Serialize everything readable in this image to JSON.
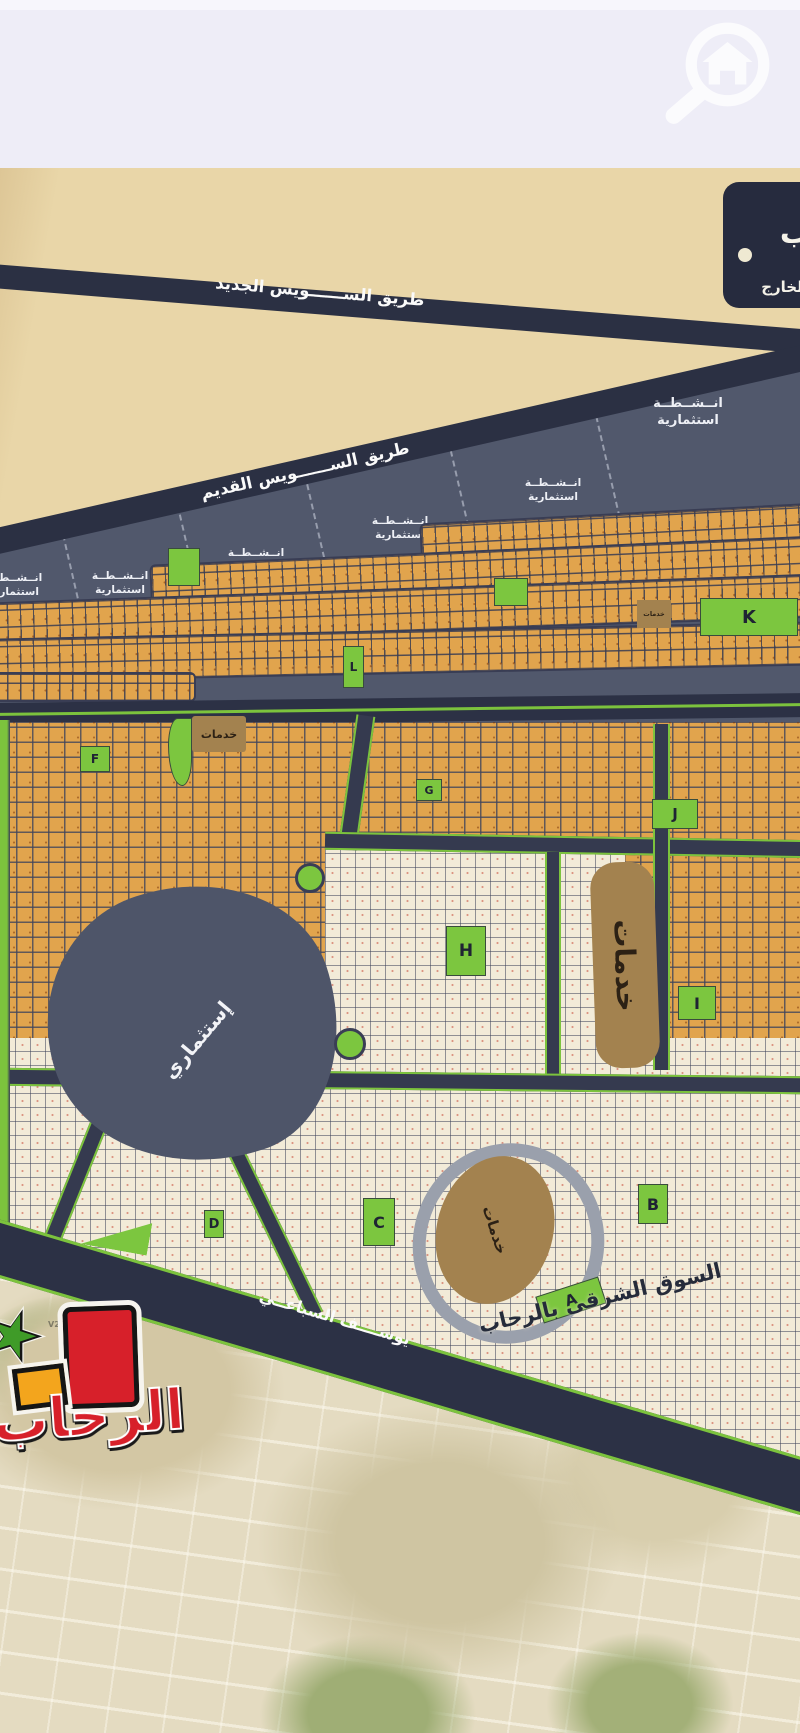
{
  "header": {
    "search_icon": "magnifier-with-house"
  },
  "legend": {
    "partial_letter": "ب",
    "subtitle": "بالخارج"
  },
  "roads": {
    "new_suez": "طريق الســــــويس الجديد",
    "old_suez": "طريق الســــــويس القديم",
    "youssef_elsebai": "يوســــف السباعــي",
    "east_market": "السوق الشرقى بالرحاب"
  },
  "zones": {
    "investment_line1": "انــشــطــة",
    "investment_line2": "استثمارية",
    "investment_blob": "إستثماري",
    "services": "خدمات"
  },
  "districts": {
    "a": "A",
    "b": "B",
    "c": "C",
    "d": "D",
    "f": "F",
    "g": "G",
    "h": "H",
    "i": "I",
    "j": "J",
    "k": "K",
    "l": "L"
  },
  "satellite_labels": {
    "v20": "V20",
    "v23": "V23",
    "v24": "V24"
  },
  "logo": {
    "text": "الرحاب"
  },
  "colors": {
    "road_navy": "#2b3043",
    "zone_navy": "#51586c",
    "plot_orange": "#e1a44d",
    "plot_cream": "#f2ebd8",
    "green": "#7cc63f",
    "services_brown": "#a3824f",
    "map_beige": "#e9d6a8",
    "header_lavender": "#eeedf7",
    "logo_red": "#d7202a"
  }
}
